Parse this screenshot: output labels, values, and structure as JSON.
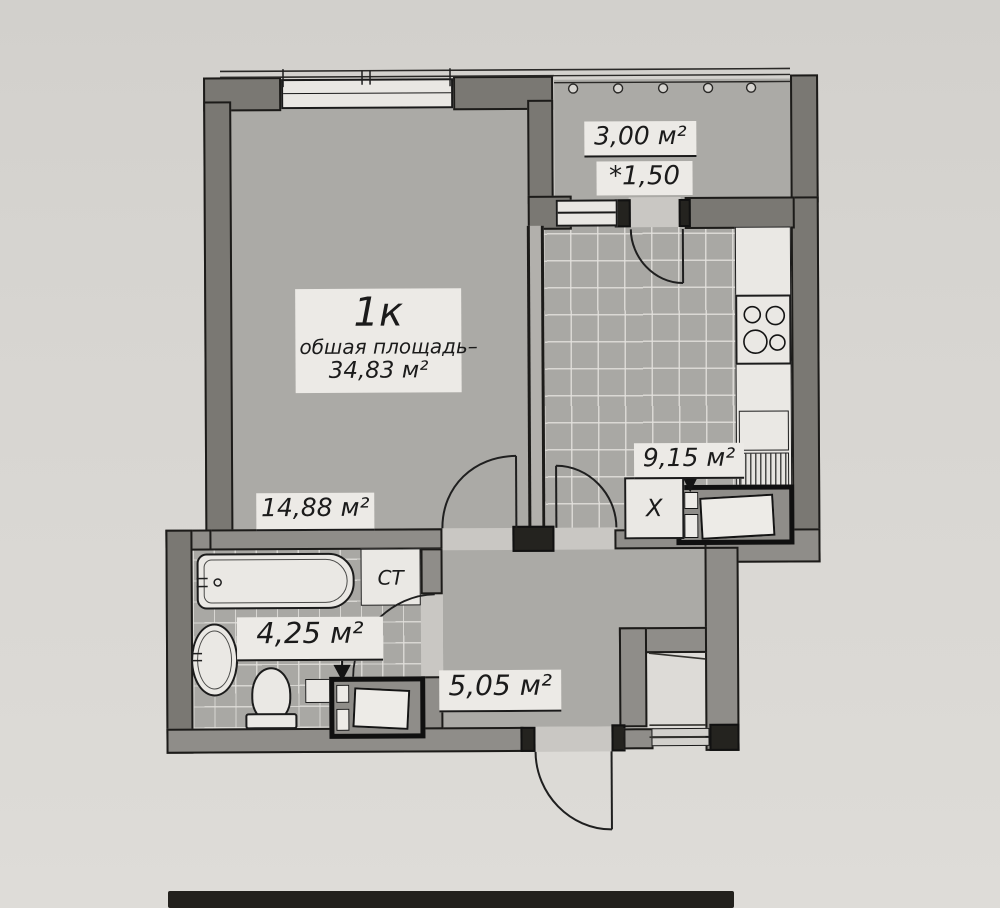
{
  "apartment": {
    "type_label": "1к",
    "total_area_caption": "обшая площадь–",
    "total_area_value": "34,83 м²"
  },
  "rooms": {
    "living": {
      "area": "14,88 м²"
    },
    "balcony": {
      "area": "3,00 м²",
      "coefficient": "*1,50"
    },
    "kitchen": {
      "area": "9,15 м²"
    },
    "bathroom": {
      "area": "4,25 м²"
    },
    "hallway": {
      "area": "5,05 м²"
    }
  },
  "fixtures": {
    "washing_machine_label": "СТ",
    "fridge_label": "X"
  },
  "colors": {
    "paper": "#d7d5d1",
    "wall_fill": "#8f8d89",
    "floor_fill": "#abaaa6",
    "line": "#1a1a1a",
    "label_background": "#eceae6"
  }
}
